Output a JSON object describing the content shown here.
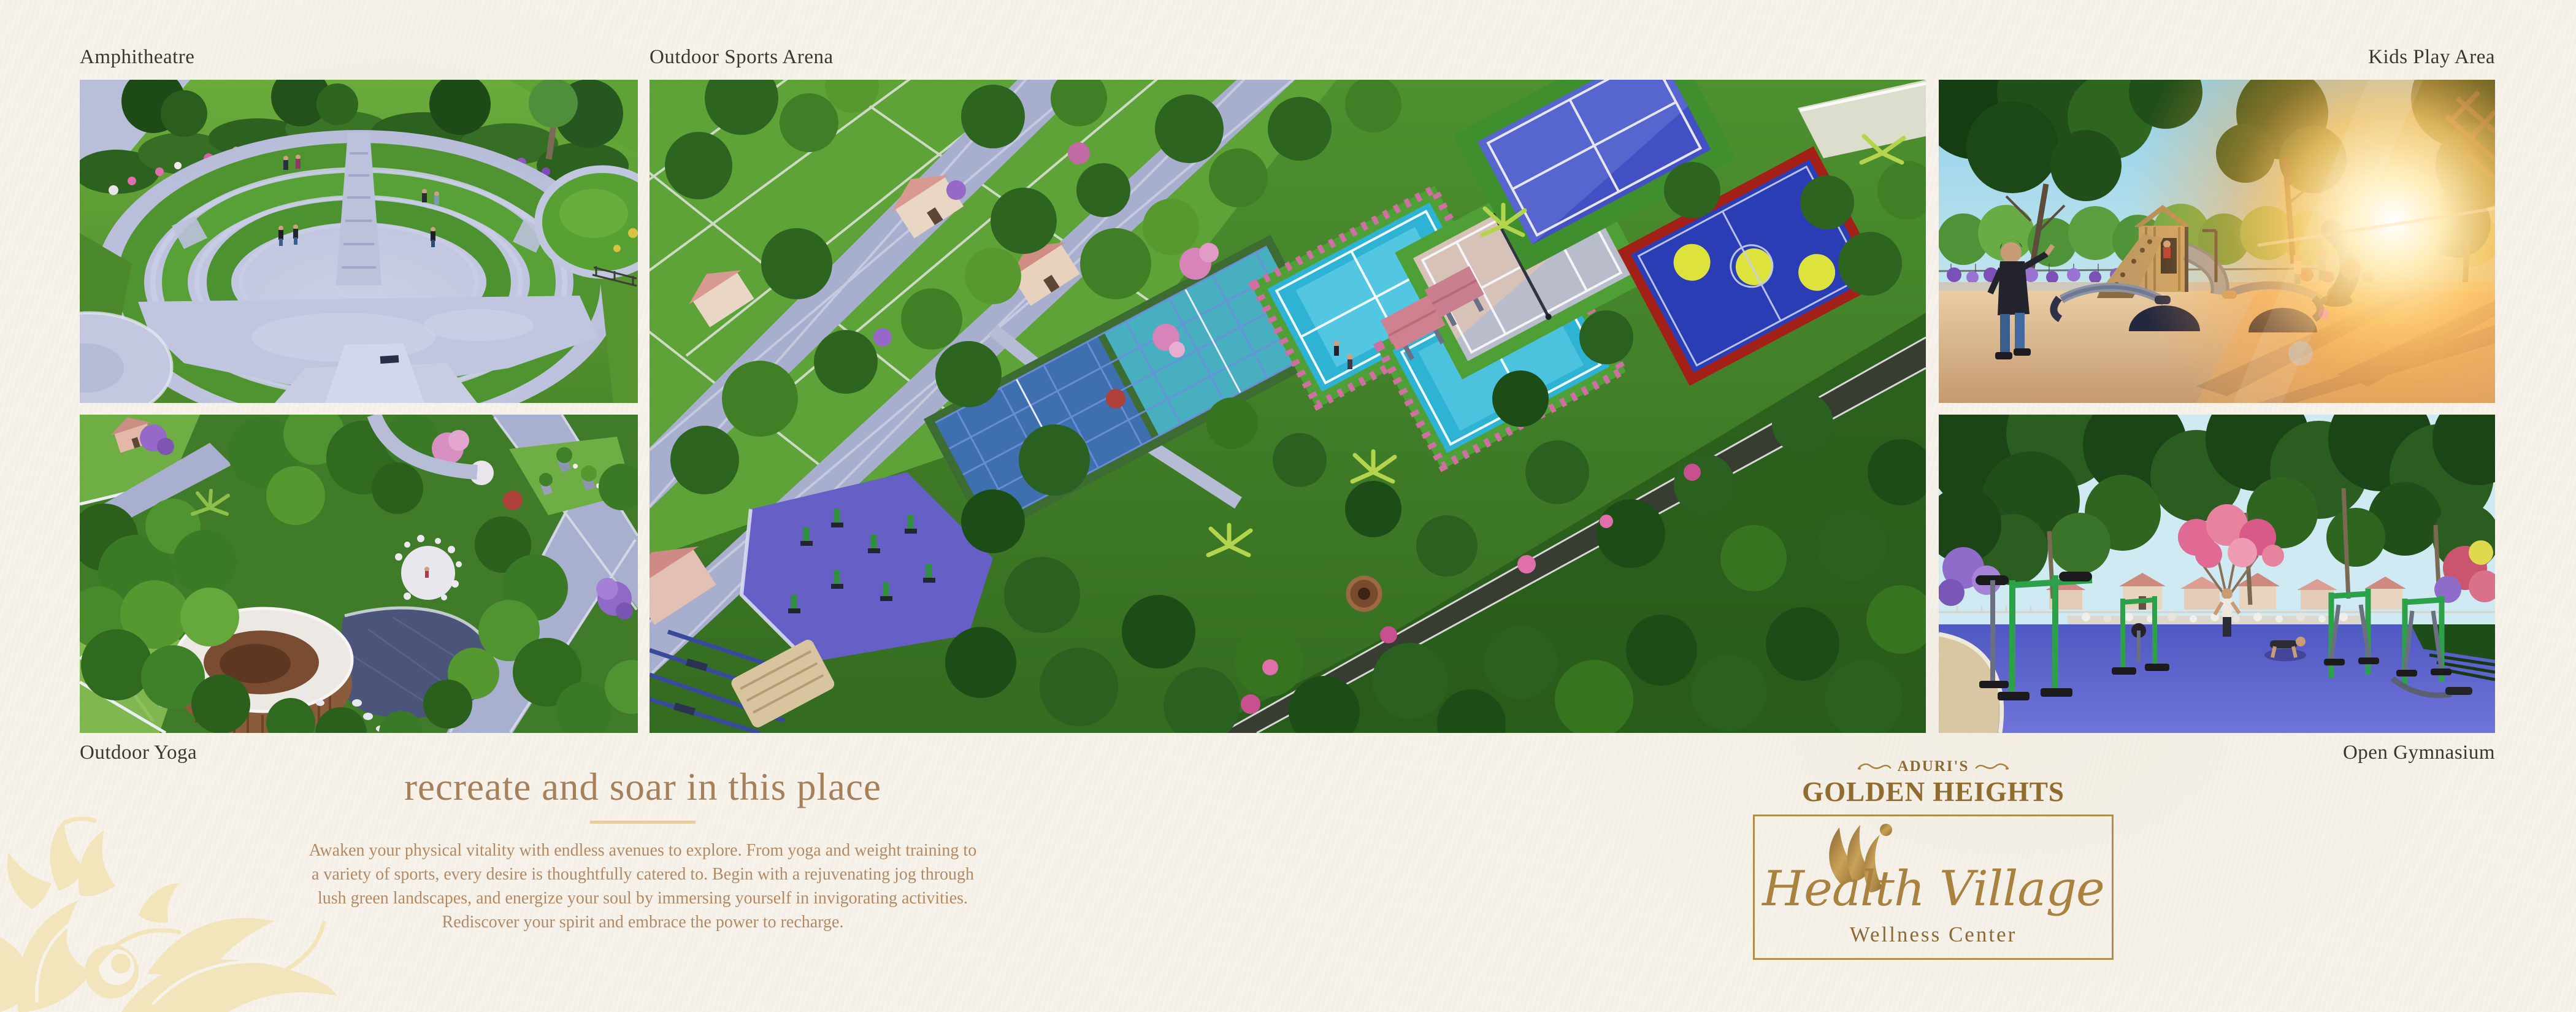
{
  "page": {
    "background_color": "#f7f3eb",
    "label_color": "#3a3733",
    "accent_gold": "#a9823f"
  },
  "gallery": {
    "amphitheatre": {
      "label": "Amphitheatre"
    },
    "sports_arena": {
      "label": "Outdoor Sports Arena"
    },
    "kids_play_area": {
      "label": "Kids Play Area"
    },
    "outdoor_yoga": {
      "label": "Outdoor Yoga"
    },
    "open_gymnasium": {
      "label": "Open Gymnasium"
    }
  },
  "headline": {
    "title": "recreate and soar in this place",
    "title_color": "#a5805b",
    "divider_color": "#e8cba1"
  },
  "paragraph": {
    "text_color": "#b18a64",
    "lines": [
      "Awaken your physical vitality with endless avenues to explore. From yoga and weight training to",
      "a variety of sports, every desire is thoughtfully catered to. Begin with a rejuvenating jog through",
      "lush green landscapes, and energize your soul by immersing yourself in invigorating activities.",
      "Rediscover your spirit and embrace the power to recharge."
    ]
  },
  "brand": {
    "prefix": "ADURI'S",
    "name": "GOLDEN HEIGHTS",
    "subbrand": "Health Village",
    "tagline": "Wellness Center",
    "gold_color": "#8f6c2f"
  }
}
